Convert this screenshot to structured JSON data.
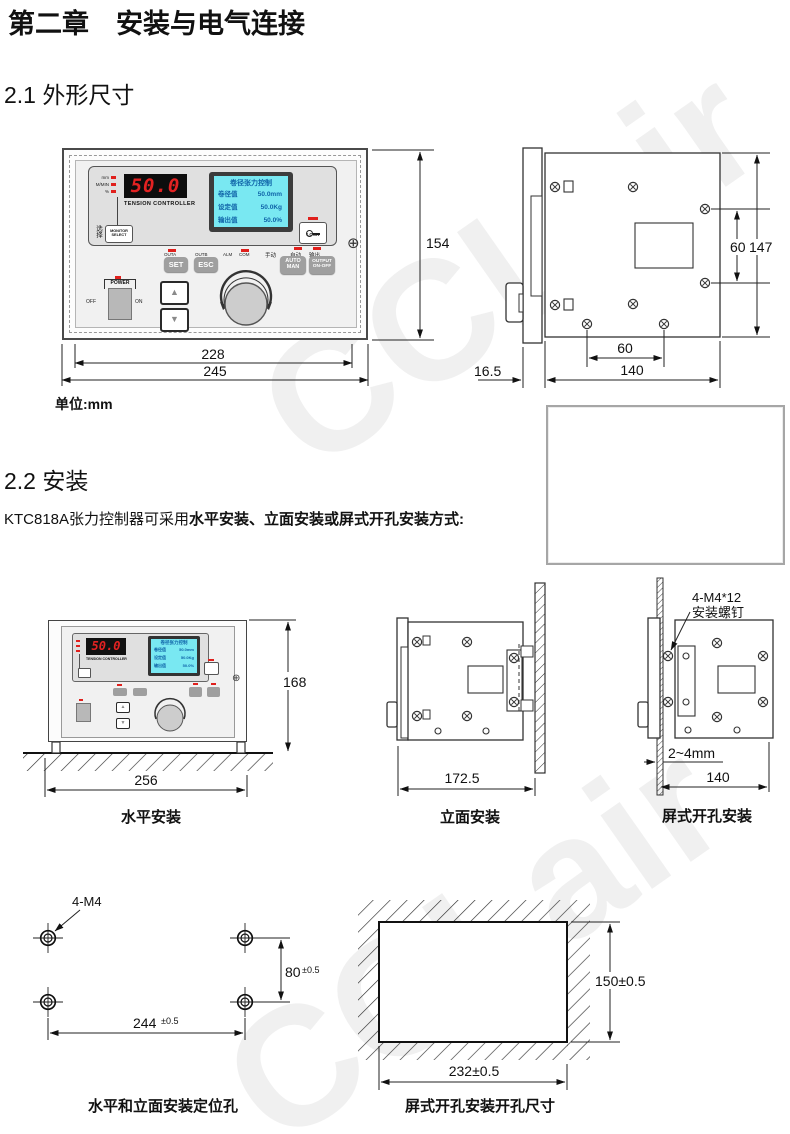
{
  "watermark": {
    "text": "CCLair"
  },
  "header": {
    "chapter_title": "第二章　安装与电气连接"
  },
  "section_21": {
    "heading": "2.1 外形尺寸",
    "unit_label": "单位:mm",
    "panel": {
      "indicators": [
        "mm",
        "M/MIN",
        "%"
      ],
      "display_value": "50.0",
      "brand": "TENSION CONTROLLER",
      "lcd": {
        "title": "卷径张力控制",
        "rows": [
          {
            "label": "卷径值",
            "value": "50.0mm"
          },
          {
            "label": "设定值",
            "value": "50.0Kg"
          },
          {
            "label": "输出值",
            "value": "50.0%"
          }
        ]
      },
      "select_cn": "选择",
      "monitor_line1": "MONITOR",
      "monitor_line2": "SELECT",
      "lock_label": "LOCK",
      "leds": {
        "outa": "OUTA",
        "outb": "OUTB",
        "alm": "ALM",
        "com": "COM",
        "manual": "手动",
        "auto": "自动",
        "output": "输出"
      },
      "buttons": {
        "set": "SET",
        "esc": "ESC",
        "auto1": "AUTO",
        "auto2": "MAN",
        "out1": "OUTPUT",
        "out2": "ON-OFF"
      },
      "power": {
        "label": "POWER",
        "off": "OFF",
        "on": "ON"
      },
      "glyphs": {
        "up": "▲",
        "down": "▼",
        "screw": "⊕"
      }
    },
    "front_dims": {
      "height": "154",
      "width_inner": "228",
      "width_outer": "245"
    },
    "side_dims": {
      "hole_spacing_v": "60",
      "height": "147",
      "hole_spacing_h": "60",
      "depth": "140",
      "bezel_depth": "16.5"
    }
  },
  "section_22": {
    "heading": "2.2 安装",
    "intro_normal": "KTC818A张力控制器可采用",
    "intro_bold": "水平安装、立面安装或屏式开孔安装方式:",
    "horizontal_mount": {
      "caption": "水平安装",
      "height": "168",
      "width": "256"
    },
    "vertical_mount": {
      "caption": "立面安装",
      "width": "172.5"
    },
    "panel_mount": {
      "caption": "屏式开孔安装",
      "screw_note_line1": "4-M4*12",
      "screw_note_line2": "安装螺钉",
      "panel_thickness": "2~4mm",
      "depth": "140"
    },
    "positioning_holes": {
      "caption": "水平和立面安装定位孔",
      "hole_label": "4-M4",
      "v_value": "80",
      "v_tol": "±0.5",
      "h_value": "244",
      "h_tol": "±0.5"
    },
    "cutout": {
      "caption": "屏式开孔安装开孔尺寸",
      "v_label": "150±0.5",
      "h_label": "232±0.5"
    }
  }
}
